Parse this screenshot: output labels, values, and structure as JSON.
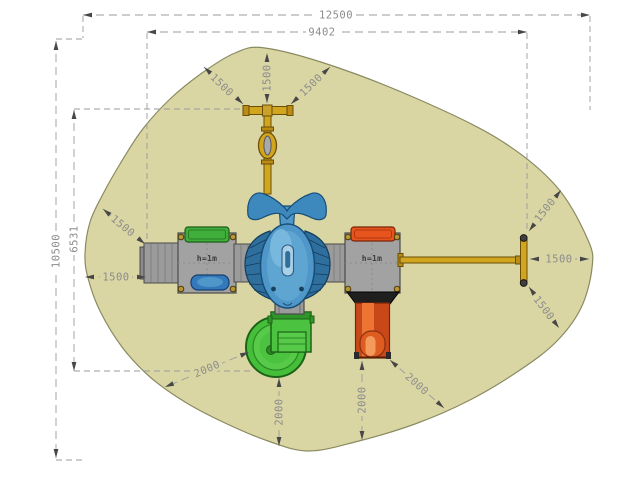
{
  "drawing": {
    "description": "Playground equipment plan view with safety zone",
    "colors": {
      "safety_zone_fill": "#d9d6a3",
      "safety_zone_outline": "#8a8a62",
      "dimension_line": "#9b9b9b",
      "dimension_text": "#8c8c8c",
      "arrow": "#474747",
      "platform_gray": "#a2a2a2",
      "walkway_gray": "#9b9b9b",
      "canopy_green": "#3fae3b",
      "canopy_orange": "#e8541e",
      "slide_green": "#45bf3a",
      "slide_orange": "#c9481a",
      "equipment_yellow": "#d2a51f",
      "dolphin_blue": "#4f97c8",
      "panel_blue": "#3579bd"
    },
    "equipment_labels": [
      {
        "text": "h=1m"
      },
      {
        "text": "h=1m"
      }
    ],
    "dimensions": [
      {
        "label": "12500",
        "x1": 83,
        "y1": 15,
        "x2": 590,
        "y2": 15,
        "lx": 336,
        "ly": 15,
        "rot": 0,
        "bg": "#ffffff"
      },
      {
        "label": "9402",
        "x1": 147,
        "y1": 32,
        "x2": 527,
        "y2": 32,
        "lx": 322,
        "ly": 32,
        "rot": 0,
        "bg": "#ffffff"
      },
      {
        "label": "10500",
        "x1": 56,
        "y1": 41,
        "x2": 56,
        "y2": 458,
        "lx": 56,
        "ly": 251,
        "rot": -90,
        "bg": "#ffffff"
      },
      {
        "label": "6531",
        "x1": 74,
        "y1": 110,
        "x2": 74,
        "y2": 371,
        "lx": 74,
        "ly": 239,
        "rot": -90,
        "bg": "#ffffff"
      },
      {
        "label": "1500",
        "x1": 243,
        "y1": 104,
        "x2": 204,
        "y2": 67,
        "lx": 222,
        "ly": 85,
        "rot": 44,
        "bg": "#d9d6a3"
      },
      {
        "label": "1500",
        "x1": 267,
        "y1": 103,
        "x2": 267,
        "y2": 53,
        "lx": 267,
        "ly": 78,
        "rot": -90,
        "bg": "#d9d6a3"
      },
      {
        "label": "1500",
        "x1": 291,
        "y1": 104,
        "x2": 330,
        "y2": 67,
        "lx": 311,
        "ly": 85,
        "rot": -44,
        "bg": "#d9d6a3"
      },
      {
        "label": "1500",
        "x1": 145,
        "y1": 244,
        "x2": 103,
        "y2": 209,
        "lx": 123,
        "ly": 226,
        "rot": 40,
        "bg": "#d9d6a3"
      },
      {
        "label": "1500",
        "x1": 146,
        "y1": 277,
        "x2": 85,
        "y2": 277,
        "lx": 116,
        "ly": 277,
        "rot": 0,
        "bg": "#d9d6a3"
      },
      {
        "label": "1500",
        "x1": 529,
        "y1": 231,
        "x2": 561,
        "y2": 190,
        "lx": 545,
        "ly": 210,
        "rot": -52,
        "bg": "#d9d6a3"
      },
      {
        "label": "1500",
        "x1": 530,
        "y1": 259,
        "x2": 589,
        "y2": 259,
        "lx": 559,
        "ly": 259,
        "rot": 0,
        "bg": "#d9d6a3"
      },
      {
        "label": "1500",
        "x1": 529,
        "y1": 287,
        "x2": 559,
        "y2": 328,
        "lx": 544,
        "ly": 308,
        "rot": 53,
        "bg": "#d9d6a3"
      },
      {
        "label": "2000",
        "x1": 249,
        "y1": 352,
        "x2": 165,
        "y2": 387,
        "lx": 207,
        "ly": 369,
        "rot": -23,
        "bg": "#d9d6a3"
      },
      {
        "label": "2000",
        "x1": 279,
        "y1": 378,
        "x2": 279,
        "y2": 446,
        "lx": 279,
        "ly": 412,
        "rot": -90,
        "bg": "#d9d6a3"
      },
      {
        "label": "2000",
        "x1": 362,
        "y1": 361,
        "x2": 362,
        "y2": 440,
        "lx": 362,
        "ly": 400,
        "rot": -90,
        "bg": "#d9d6a3"
      },
      {
        "label": "2000",
        "x1": 390,
        "y1": 360,
        "x2": 444,
        "y2": 408,
        "lx": 417,
        "ly": 384,
        "rot": 42,
        "bg": "#d9d6a3"
      }
    ],
    "extension_lines": [
      [
        83,
        16,
        83,
        38
      ],
      [
        56,
        39,
        83,
        39
      ],
      [
        590,
        16,
        590,
        110
      ],
      [
        527,
        33,
        527,
        231
      ],
      [
        147,
        33,
        147,
        253
      ],
      [
        74,
        109,
        243,
        109
      ],
      [
        74,
        371,
        250,
        371
      ],
      [
        56,
        460,
        85,
        460
      ]
    ]
  }
}
